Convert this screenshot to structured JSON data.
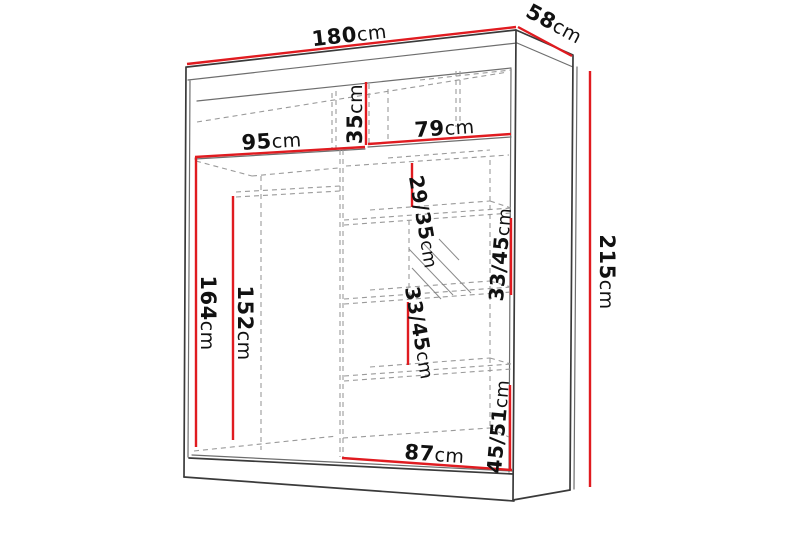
{
  "diagram": {
    "kind": "wardrobe-dimension-drawing",
    "colors": {
      "dimension_line": "#e01b20",
      "outline": "#3a3a3a",
      "hidden_edge": "#9a9a9a",
      "background": "#ffffff"
    }
  },
  "dimensions": {
    "width": {
      "value": "180",
      "unit": "cm"
    },
    "depth": {
      "value": "58",
      "unit": "cm"
    },
    "height": {
      "value": "215",
      "unit": "cm"
    },
    "left_section_width": {
      "value": "95",
      "unit": "cm"
    },
    "top_shelf_height": {
      "value": "35",
      "unit": "cm"
    },
    "right_section_width": {
      "value": "79",
      "unit": "cm"
    },
    "hanging_space_height": {
      "value": "164",
      "unit": "cm"
    },
    "rod_height": {
      "value": "152",
      "unit": "cm"
    },
    "shelf_gap_top": {
      "value": "29/35",
      "unit": "cm"
    },
    "shelf_gap_mirror": {
      "value": "33/45",
      "unit": "cm"
    },
    "shelf_gap_lower": {
      "value": "33/45",
      "unit": "cm"
    },
    "shelf_gap_bottom": {
      "value": "45/51",
      "unit": "cm"
    },
    "bottom_section_width": {
      "value": "87",
      "unit": "cm"
    }
  }
}
